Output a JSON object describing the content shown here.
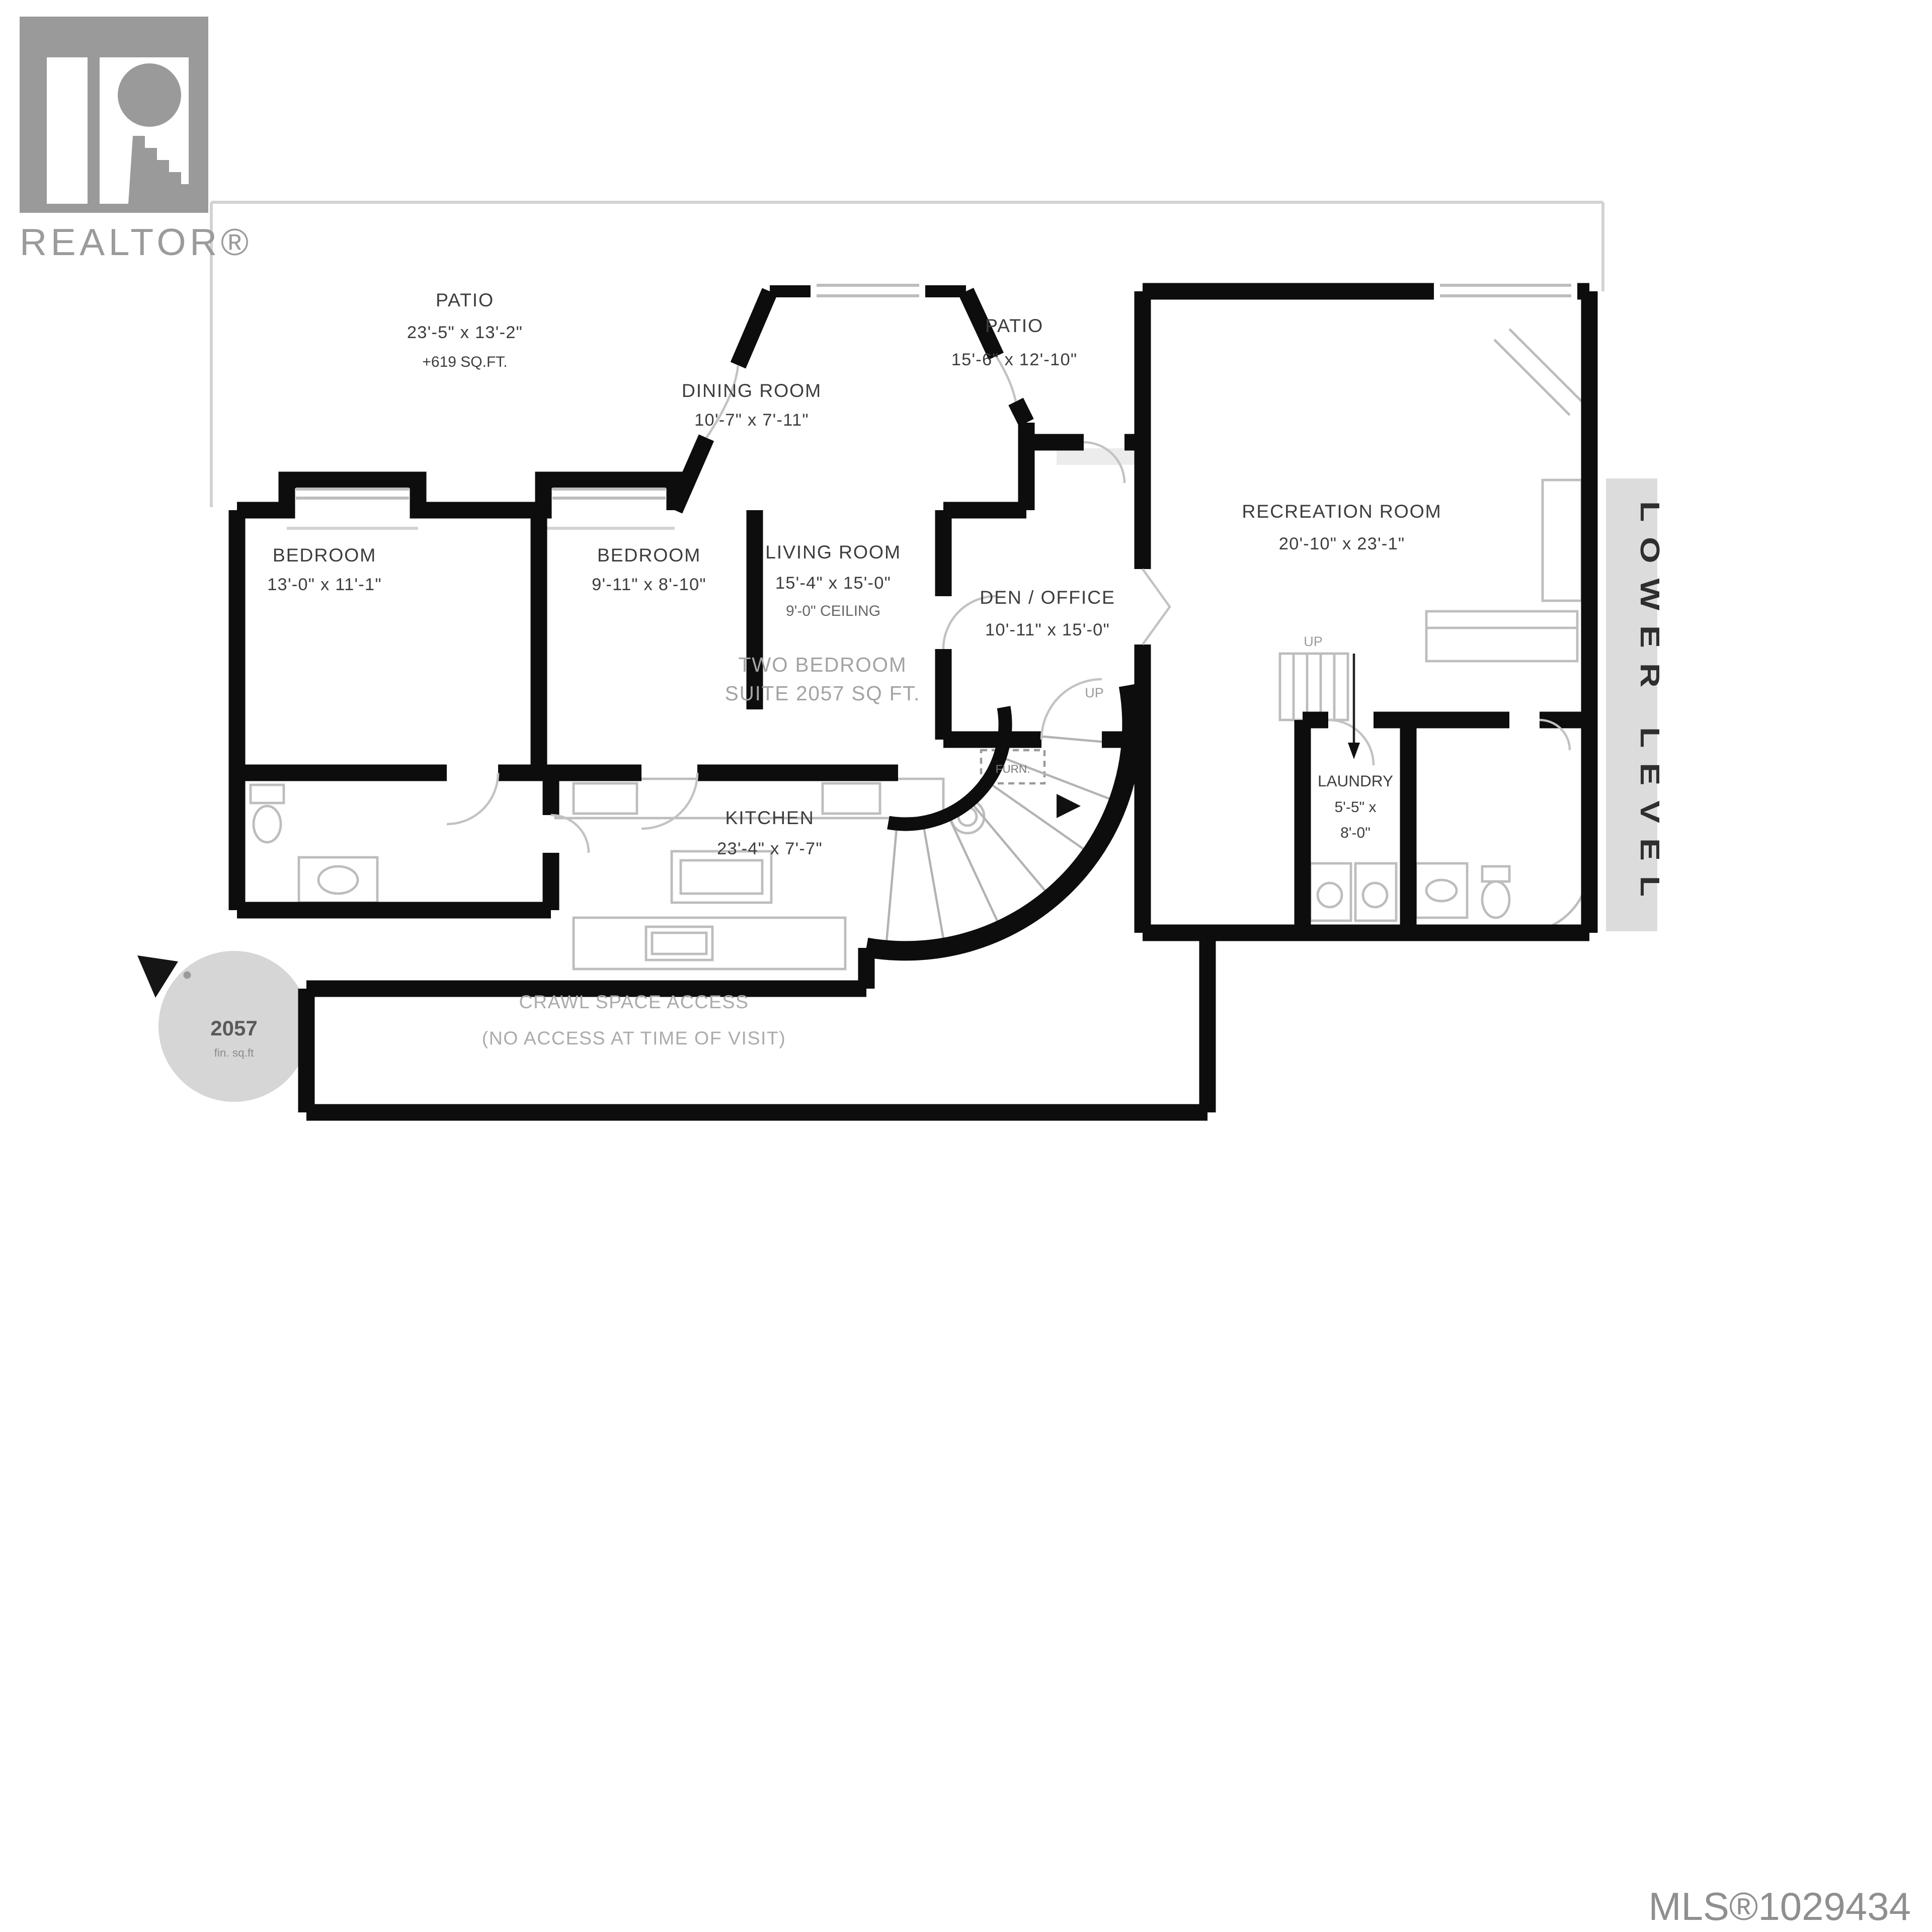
{
  "branding": {
    "logo_text": "REALTOR®"
  },
  "mls_number": "MLS®1029434",
  "level_label": "LOWER LEVEL",
  "area_badge": {
    "value": "2057",
    "unit": "fin. sq.ft"
  },
  "rooms": {
    "patio_left": {
      "name": "PATIO",
      "dims": "23'-5\" x 13'-2\"",
      "area": "+619 SQ.FT."
    },
    "dining": {
      "name": "DINING ROOM",
      "dims": "10'-7\" x 7'-11\""
    },
    "patio_right": {
      "name": "PATIO",
      "dims": "15'-6\" x 12'-10\""
    },
    "recreation": {
      "name": "RECREATION ROOM",
      "dims": "20'-10\" x 23'-1\""
    },
    "bedroom1": {
      "name": "BEDROOM",
      "dims": "13'-0\" x 11'-1\""
    },
    "bedroom2": {
      "name": "BEDROOM",
      "dims": "9'-11\" x 8'-10\""
    },
    "living": {
      "name": "LIVING ROOM",
      "dims": "15'-4\" x 15'-0\"",
      "ceiling": "9'-0\" CEILING"
    },
    "den": {
      "name": "DEN / OFFICE",
      "dims": "10'-11\" x 15'-0\""
    },
    "kitchen": {
      "name": "KITCHEN",
      "dims": "23'-4\" x 7'-7\""
    },
    "laundry": {
      "name": "LAUNDRY",
      "dims_line1": "5'-5\" x",
      "dims_line2": "8'-0\""
    }
  },
  "annotations": {
    "suite_line1": "TWO BEDROOM",
    "suite_line2": "SUITE 2057 SQ FT.",
    "crawl_line1": "CRAWL SPACE ACCESS",
    "crawl_line2": "(NO ACCESS AT TIME OF VISIT)",
    "up": "UP",
    "furnace": "FURN."
  }
}
